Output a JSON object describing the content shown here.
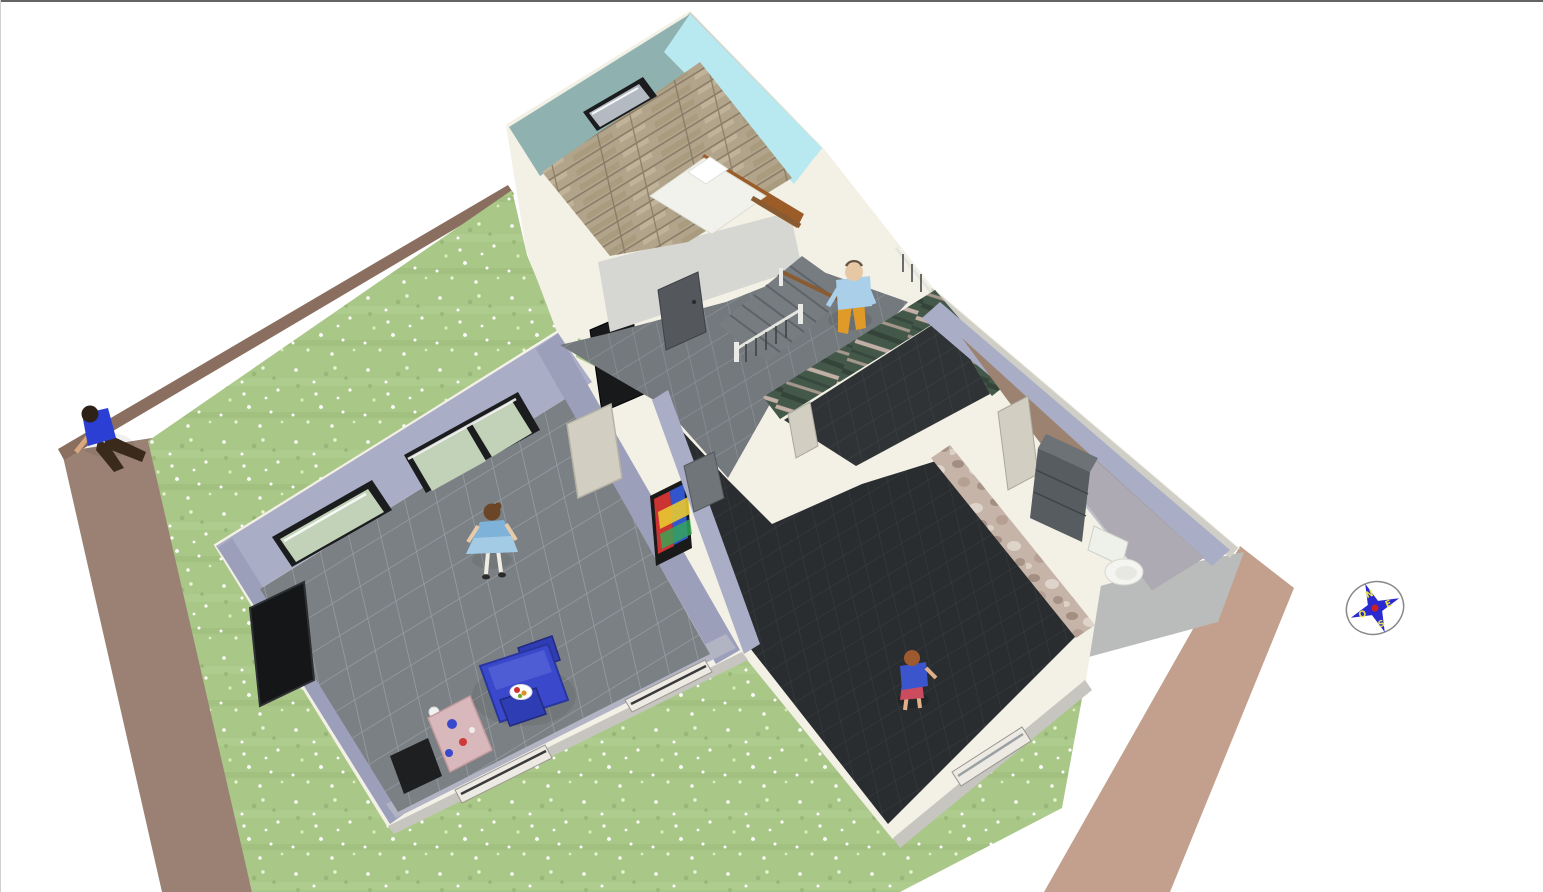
{
  "view": {
    "name": "aerial-3d-home-view",
    "border_top_color": "#646464",
    "border_left_color": "#d0d0d0",
    "background": "#ffffff"
  },
  "palette": {
    "lawn": "#a9c787",
    "lawn_speckle": "#ffffff",
    "lawn_light": "#dcebc0",
    "lawn_dark": "#93b272",
    "dirt_left": "#9a8173",
    "dirt_top": "#8a6f60",
    "dirt_right": "#c2a08d",
    "apron": "#b9bcba",
    "wall_top": "#f3f0e6",
    "wall_outer_shade": "#cfcec7",
    "wall_inner_gray": "#d6d6d2",
    "lavender": "#a9adc6",
    "lavender_dark": "#9b9fba",
    "lavender_soft": "#b2b4c4",
    "teal": "#8fb2b0",
    "cyan": "#b9e9f0",
    "wood": "#b2a48b",
    "wood_seam": "#897c66",
    "tile_living": "#7b8084",
    "tile_living_grout": "#989ea3",
    "tile_hall": "#74797e",
    "tile_hall_grout": "#8b9196",
    "tile_dark": "#2f3336",
    "tile_dark_grout": "#3d4246",
    "marble_green": "#44584a",
    "marble_vein": "#d8bfb5",
    "stone": "#c6b4a9",
    "stone_dark": "#9a8578",
    "stone_light": "#e2d8cd",
    "wc_floor": "#9c8270",
    "glass_green": "#c2d2b8",
    "glass_gray": "#b4bac2",
    "frame_dark": "#1a1c1e",
    "door_black": "#17191b",
    "door_dark_gray": "#54585c",
    "door_gray": "#70757a",
    "door_light": "#d2cfc2",
    "step": "#777c81",
    "railing_silver": "#e5e5e0",
    "railing_dark": "#3c3f43",
    "handrail_brown": "#8a5a30",
    "sill_white": "#eceae2"
  },
  "furniture": {
    "bed_mattress": "#f2f2ec",
    "bed_pillow": "#ffffff",
    "bed_headboard": "#9c5c28",
    "table_blue": "#3a49cc",
    "table_highlight": "#5a68d8",
    "chair_blue": "#2f3db4",
    "plate_white": "#ffffff",
    "counter_pink": "#d8b8ba",
    "tv_black": "#141618",
    "hearth_black": "#1d1f21",
    "toilet_white": "#f4f4f0",
    "dresser_dark": "#575c60",
    "dresser_top": "#6c7276",
    "painting_red": "#cc3333",
    "painting_blue": "#3355cc",
    "painting_yellow": "#e8c830",
    "painting_green": "#33aa55",
    "ball_white": "#f2f2f0"
  },
  "people": [
    {
      "id": "man-garden",
      "shirt": "#2b3fd4",
      "pants": "#3a2a1c",
      "skin": "#d9a77d",
      "hair": "#2e2218"
    },
    {
      "id": "man-stairs",
      "shirt": "#a9d0e8",
      "pants": "#e09a28",
      "skin": "#e6c8a4",
      "hair": "#6b553f"
    },
    {
      "id": "woman-living",
      "dress": "#7fb2d8",
      "skirt": "#a8cde8",
      "skin": "#e8c9a8",
      "hair": "#6a4526",
      "legs": "#f0ece4"
    },
    {
      "id": "child-playroom",
      "shirt": "#3b55cc",
      "shorts": "#cc4b5e",
      "skin": "#e2b088",
      "hair": "#9c5a2e"
    }
  ],
  "compass": {
    "labels": [
      "N",
      "E",
      "S",
      "O"
    ],
    "ring": "#8a8a8a",
    "star": "#2a2ad0",
    "dot": "#cc2020",
    "letter": "#e8e24a"
  }
}
